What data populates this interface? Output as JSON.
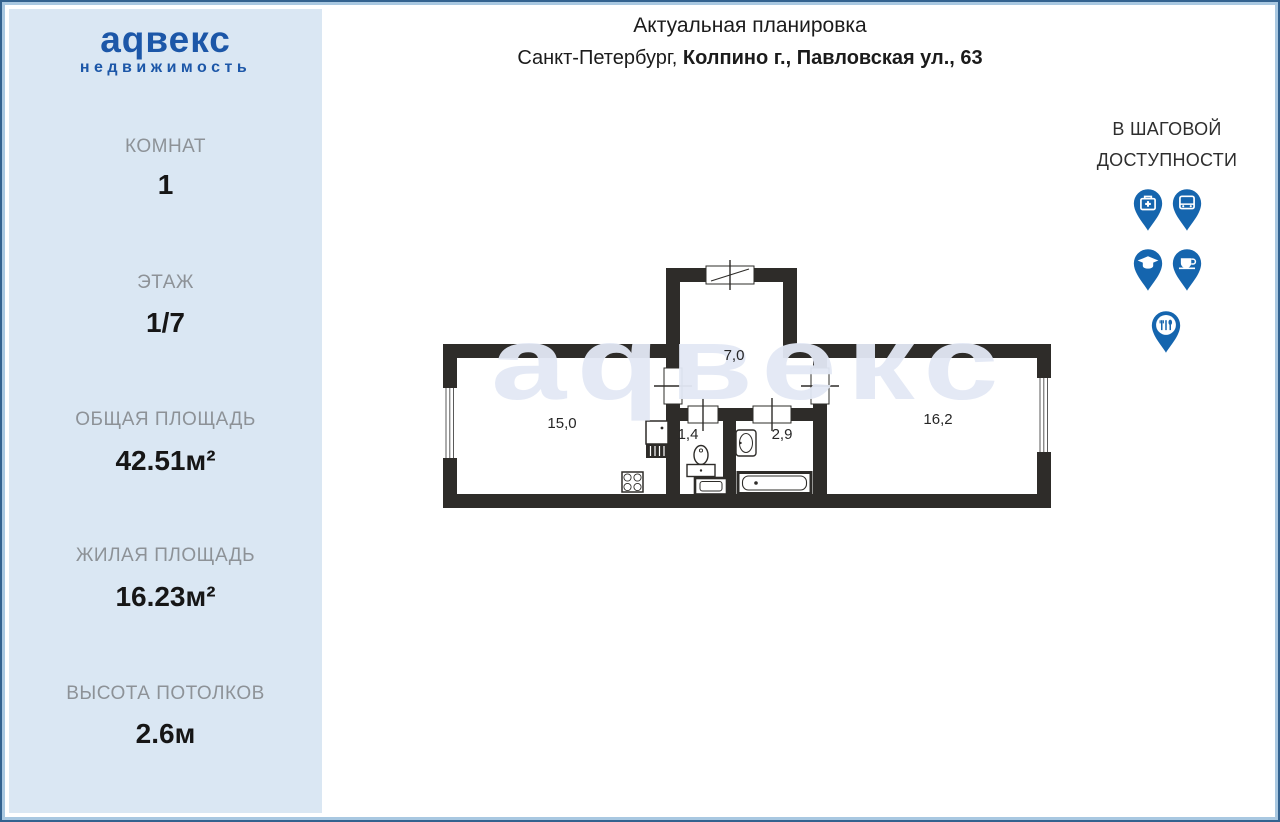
{
  "brand": {
    "name": "аqвекс",
    "tagline": "недвижимость"
  },
  "header": {
    "title": "Актуальная планировка",
    "address_regular": "Санкт-Петербург, ",
    "address_bold": "Колпино г., Павловская ул., 63"
  },
  "sidebar": {
    "stats": [
      {
        "label": "КОМНАТ",
        "value": "1"
      },
      {
        "label": "ЭТАЖ",
        "value": "1/7"
      },
      {
        "label": "ОБЩАЯ ПЛОЩАДЬ",
        "value": "42.51м²"
      },
      {
        "label": "ЖИЛАЯ ПЛОЩАДЬ",
        "value": "16.23м²"
      },
      {
        "label": "ВЫСОТА ПОТОЛКОВ",
        "value": "2.6м"
      }
    ]
  },
  "amenities": {
    "title_line1": "В ШАГОВОЙ",
    "title_line2": "ДОСТУПНОСТИ",
    "icons": [
      "medical",
      "bus",
      "education",
      "cafe",
      "restaurant"
    ]
  },
  "floorplan": {
    "watermark": "аqвекс",
    "room_areas": {
      "hallway": "7,0",
      "kitchen_living": "15,0",
      "wc": "1,4",
      "bathroom": "2,9",
      "room": "16,2"
    }
  },
  "colors": {
    "brand_blue": "#1c57a8",
    "pin_blue": "#1565ae",
    "sidebar_bg": "#dae7f3",
    "wall": "#2e2c29",
    "watermark": "#e4e8f4"
  }
}
